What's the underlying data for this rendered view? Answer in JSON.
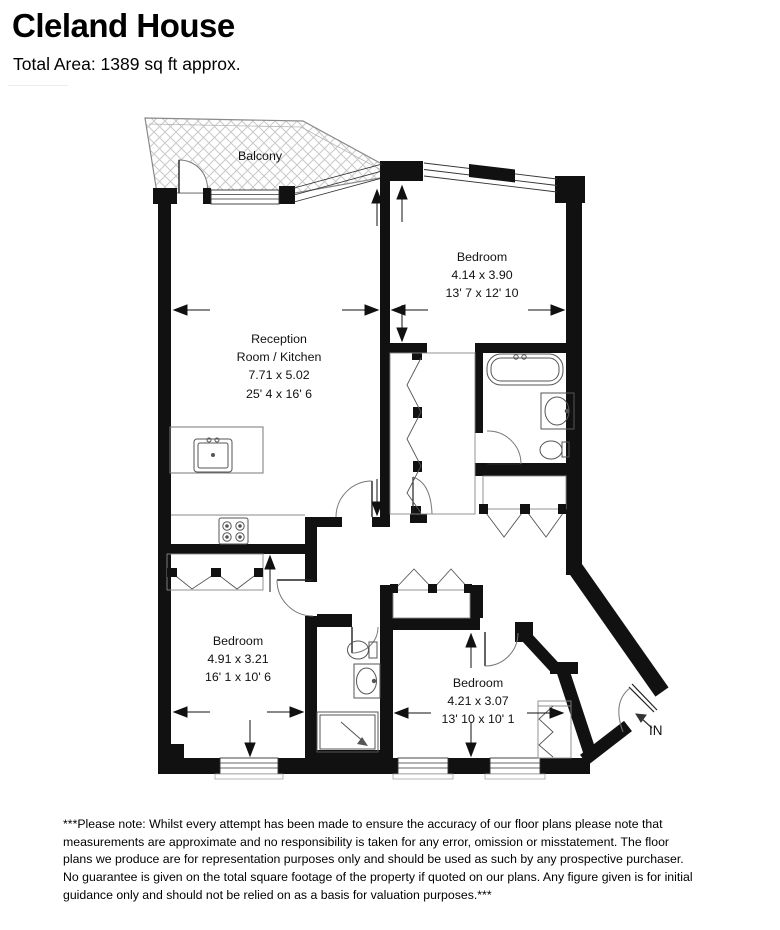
{
  "header": {
    "title": "Cleland House",
    "subtitle": "Total Area: 1389 sq ft approx."
  },
  "floorplan": {
    "balcony_label": "Balcony",
    "reception": {
      "line1": "Reception",
      "line2": "Room / Kitchen",
      "metric": "7.71 x 5.02",
      "imperial": "25' 4 x 16' 6"
    },
    "bedroom_top_right": {
      "label": "Bedroom",
      "metric": "4.14 x 3.90",
      "imperial": "13' 7 x 12' 10"
    },
    "bedroom_bottom_left": {
      "label": "Bedroom",
      "metric": "4.91 x 3.21",
      "imperial": "16' 1 x 10' 6"
    },
    "bedroom_bottom_right": {
      "label": "Bedroom",
      "metric": "4.21 x 3.07",
      "imperial": "13' 10 x 10' 1"
    },
    "entrance_label": "IN",
    "colors": {
      "walls": "#111111",
      "hatch": "#c9c9c9",
      "fixtures": "#555555",
      "text": "#111111"
    }
  },
  "disclaimer": "***Please note: Whilst every attempt has been made to ensure the accuracy of our floor plans please note that\nmeasurements are approximate and no responsibility is taken for any error, omission or misstatement. The floor\nplans we produce are for representation purposes only and should be used as such by any prospective purchaser.\nNo guarantee is given on the total square footage of the property if quoted on our plans. Any figure given is for initial\nguidance only and should not be relied on as a basis for valuation purposes.***"
}
